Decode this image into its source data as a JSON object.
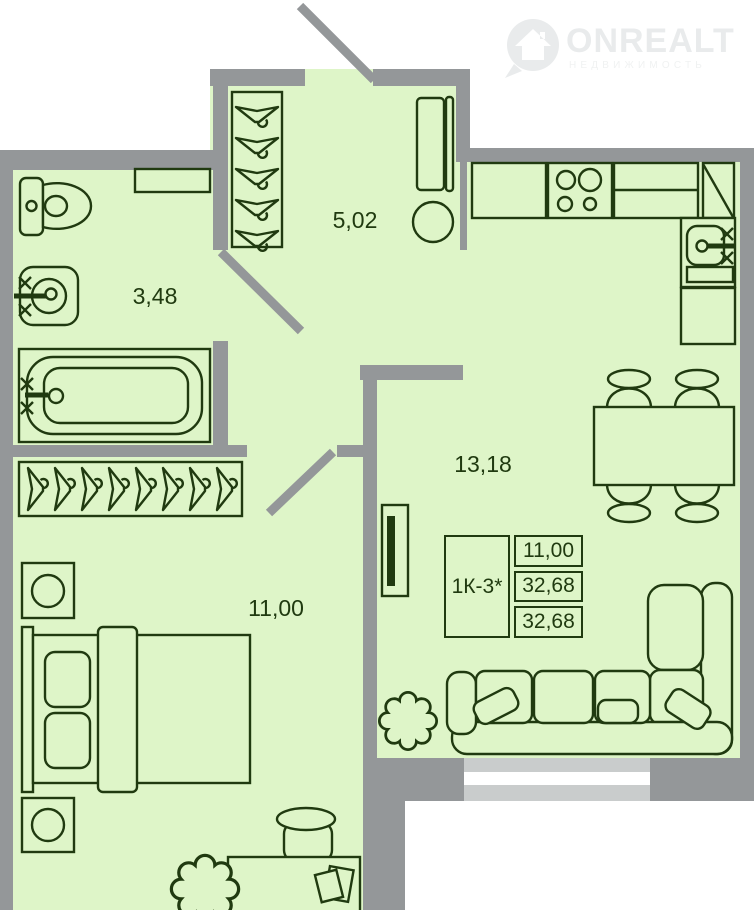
{
  "watermark": {
    "brand": "ONREALT",
    "tagline": "НЕДВИЖИМОСТЬ"
  },
  "rooms": [
    {
      "id": "hallway",
      "label": "5,02"
    },
    {
      "id": "bathroom",
      "label": "3,48"
    },
    {
      "id": "living_kitchen",
      "label": "13,18"
    },
    {
      "id": "bedroom",
      "label": "11,00"
    }
  ],
  "info_table": {
    "unit": "1К-3*",
    "values": [
      "11,00",
      "32,68",
      "32,68"
    ]
  },
  "colors": {
    "floor": "#def5c8",
    "wall": "#949799",
    "window": "#c9cccc",
    "line": "#203a10",
    "watermark": "#e9ebec",
    "watermark_sub": "#f0f2f2",
    "bg": "#ffffff"
  }
}
